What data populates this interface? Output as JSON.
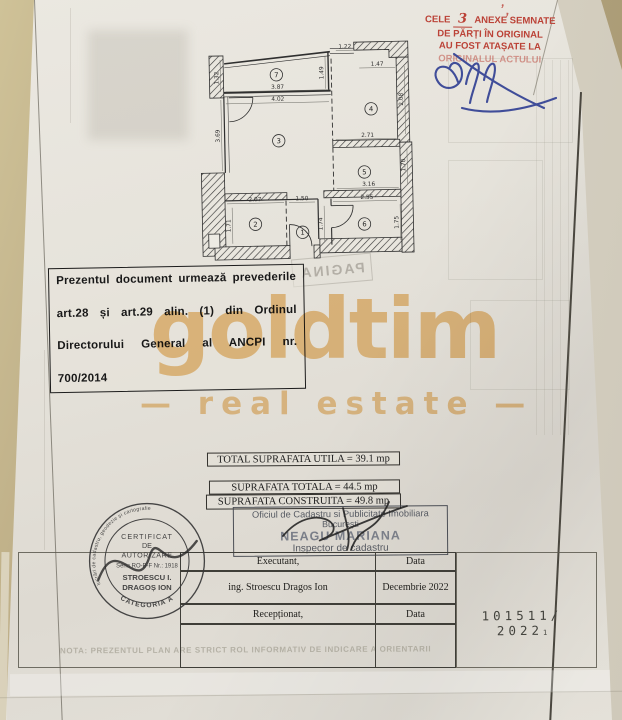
{
  "colors": {
    "paper": "#e6e2d9",
    "fabric": "#b7a782",
    "stamp_red": "#bb4237",
    "ink_blue": "#2e3d92",
    "watermark": "#eec287",
    "stamp_ink": "#383838"
  },
  "document": {
    "red_stamp": {
      "line1_prefix": "CELE",
      "handwritten_count": "3",
      "line1_suffix": "ANEXE SEMNATE",
      "line2": "DE PĂRȚI ÎN ORIGINAL",
      "line3": "AU FOST ATAȘATE LA",
      "line4": "ORIGINALUL ACTULUI",
      "corner_marks": "’ ,"
    },
    "legal_notice": {
      "line1": "Prezentul document urmează prevederile",
      "line2": "art.28 și art.29 alin. (1) din Ordinul",
      "line3": "Directorului General al ANCPI nr.",
      "line4": "700/2014"
    },
    "pagina_bleedthrough": "PAGINA",
    "watermark": {
      "name": "goldtim",
      "tagline": "—  real estate  —"
    },
    "floor_plan": {
      "rooms": [
        {
          "n": "1",
          "x": 105,
          "y": 196
        },
        {
          "n": "2",
          "x": 58,
          "y": 187
        },
        {
          "n": "3",
          "x": 83,
          "y": 104
        },
        {
          "n": "4",
          "x": 176,
          "y": 74
        },
        {
          "n": "5",
          "x": 168,
          "y": 137
        },
        {
          "n": "6",
          "x": 167,
          "y": 189
        },
        {
          "n": "7",
          "x": 82,
          "y": 38
        }
      ],
      "dimensions": [
        {
          "t": "1.32",
          "x": 24,
          "y": 40,
          "r": 1
        },
        {
          "t": "3.87",
          "x": 83,
          "y": 52,
          "r": 0
        },
        {
          "t": "4.02",
          "x": 83,
          "y": 64,
          "r": 0
        },
        {
          "t": "1.49",
          "x": 129,
          "y": 37,
          "r": 1
        },
        {
          "t": "1.22",
          "x": 151,
          "y": 13,
          "r": 0
        },
        {
          "t": "1.47",
          "x": 183,
          "y": 31,
          "r": 0
        },
        {
          "t": "2.08",
          "x": 208,
          "y": 65,
          "r": 1
        },
        {
          "t": "2.71",
          "x": 172,
          "y": 102,
          "r": 0
        },
        {
          "t": "3.69",
          "x": 24,
          "y": 98,
          "r": 1
        },
        {
          "t": "1.70",
          "x": 209,
          "y": 131,
          "r": 1
        },
        {
          "t": "3.16",
          "x": 172,
          "y": 151,
          "r": 0
        },
        {
          "t": "2.07",
          "x": 58,
          "y": 164,
          "r": 0
        },
        {
          "t": "1.50",
          "x": 105,
          "y": 164,
          "r": 0
        },
        {
          "t": "2.55",
          "x": 170,
          "y": 164,
          "r": 0
        },
        {
          "t": "1.71",
          "x": 33,
          "y": 188,
          "r": 1
        },
        {
          "t": "1.74",
          "x": 125,
          "y": 188,
          "r": 1
        },
        {
          "t": "1.75",
          "x": 201,
          "y": 188,
          "r": 1
        }
      ]
    },
    "areas_table": {
      "head": {
        "c1a": "Nr.",
        "c1b": "crt.",
        "c2a": "Denumire",
        "c2b": "incapere",
        "c3a": "Suprafata",
        "c3b": "[mp]"
      },
      "rows": [
        {
          "nr": "1",
          "name": "Hol",
          "area": "2.6"
        },
        {
          "nr": "2",
          "name": "Depozitare",
          "area": "3.6"
        },
        {
          "nr": "3",
          "name": "Zona zi",
          "area": "14.8"
        },
        {
          "nr": "4",
          "name": "Zona noapte",
          "area": "8.7"
        },
        {
          "nr": "5",
          "name": "Bucatarie",
          "area": "5.0"
        },
        {
          "nr": "6",
          "name": "Baie",
          "area": "4.4"
        }
      ],
      "total_utila": "TOTAL SUPRAFATA UTILA = 39.1 mp",
      "balcon_row": {
        "nr": "7",
        "name": "Balcon",
        "area": "5.4"
      },
      "total_totala": "SUPRAFATA TOTALA = 44.5 mp",
      "total_construita": "SUPRAFATA CONSTRUITA = 49.8 mp"
    },
    "ocpi_stamp": {
      "line1": "Oficiul de Cadastru si Publicitate Imobiliara",
      "line2": "București",
      "line3": "NEAGU MARIANA",
      "line4": "Inspector de cadastru"
    },
    "round_stamp": {
      "ring_text": "Persoană autorizată de ANCPI să execute lucrări de cadastru, geodezie și cartografie",
      "l1": "CERTIFICAT",
      "l2": "DE",
      "l3": "AUTORIZARE",
      "l4": "Seria RO-B-F Nr.: 1918",
      "l5": "STROESCU I.",
      "l6": "DRAGOȘ ION",
      "arc_bottom": "CATEGORIA A"
    },
    "sign_table": {
      "r1c1": "Executant,",
      "r1c2": "Data",
      "r2c1": "ing. Stroescu Dragos Ion",
      "r2c2": "Decembrie 2022",
      "r3c1": "Recepționat,",
      "r3c2": "Data"
    },
    "registration_number": "101511/ 2022",
    "registration_suffix": "1",
    "nota": "NOTA: PREZENTUL PLAN ARE STRICT ROL INFORMATIV DE INDICARE A ORIENTARII"
  }
}
